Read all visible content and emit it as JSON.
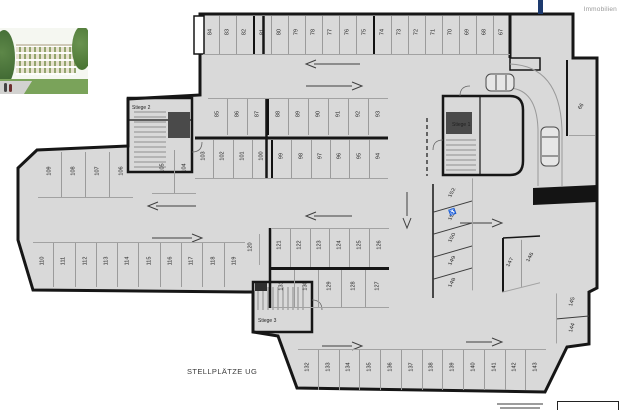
{
  "branding": {
    "company": "Immobilien",
    "bar_color": "#1d3a6e",
    "text_color": "#9a9a9a"
  },
  "plan": {
    "title": "STELLPLÄTZE UG",
    "floor_color": "#d9d9d9",
    "wall_color": "#161616",
    "stairwells": {
      "s1": "Stiege 1",
      "s2": "Stiege 2",
      "s3": "Stiege 3"
    },
    "accessible_icon": "♿",
    "rows": {
      "top": [
        "84",
        "83",
        "82",
        "81",
        "80",
        "79",
        "78",
        "77",
        "76",
        "75",
        "74",
        "73",
        "72",
        "71",
        "70",
        "69",
        "68",
        "67"
      ],
      "mid_upper": [
        "85",
        "86",
        "87",
        "88",
        "89",
        "90",
        "91",
        "92",
        "93"
      ],
      "mid_lower": [
        "103",
        "102",
        "101",
        "100",
        "99",
        "98",
        "97",
        "96",
        "95",
        "94"
      ],
      "mid_left": [
        "105",
        "104"
      ],
      "left_wing": [
        "109",
        "108",
        "107",
        "106"
      ],
      "bottom_left": [
        "110",
        "111",
        "112",
        "113",
        "114",
        "115",
        "116",
        "117",
        "118",
        "119"
      ],
      "low_upper": [
        "121",
        "122",
        "123",
        "124",
        "125",
        "126"
      ],
      "low_lower": [
        "131",
        "130",
        "129",
        "128",
        "127"
      ],
      "bottom": [
        "132",
        "133",
        "134",
        "135",
        "136",
        "137",
        "138",
        "139",
        "140",
        "141",
        "142",
        "143"
      ],
      "right_diag": [
        "152",
        "151",
        "150",
        "149",
        "148"
      ],
      "right_pair": [
        "147",
        "146"
      ],
      "right_edge": [
        "145",
        "144"
      ]
    },
    "single_stalls": {
      "s120": "120",
      "s66": "66"
    }
  }
}
